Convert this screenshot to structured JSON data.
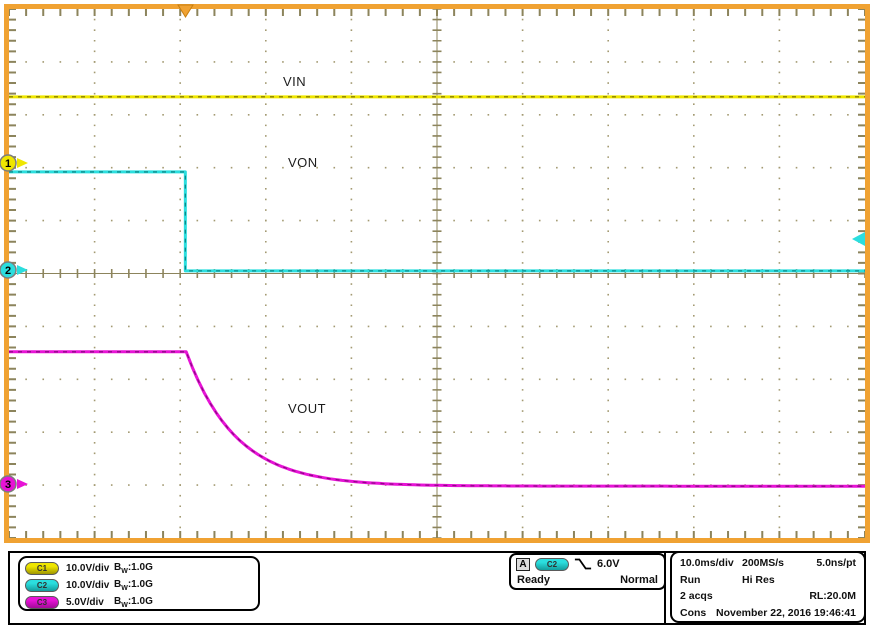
{
  "colors": {
    "frame": "#F0A232",
    "graticule": "#8C845C",
    "grid_dot": "#A39A72",
    "c1": {
      "main": "#EFE600",
      "dark": "#8A8000"
    },
    "c2": {
      "main": "#2BDEDE",
      "dark": "#0C8A8A"
    },
    "c3": {
      "main": "#E713D6",
      "dark": "#8F0886"
    }
  },
  "display": {
    "labels": {
      "vin": "VIN",
      "von": "VON",
      "vout": "VOUT"
    }
  },
  "markers": {
    "channel_refs": [
      {
        "label": "1",
        "channel": "C1",
        "y_div": 2.91
      },
      {
        "label": "2",
        "channel": "C2",
        "y_div": 4.93
      },
      {
        "label": "3",
        "channel": "C3",
        "y_div": 8.98
      }
    ],
    "trigger_position": {
      "x_div": 2.06
    },
    "trigger_level": {
      "y_div": 4.35,
      "channel": "C2"
    }
  },
  "channels": [
    {
      "id": "C1",
      "scale": "10.0V/div",
      "bw_b": "B",
      "bw_sub": "W",
      "bw_val": ":1.0G"
    },
    {
      "id": "C2",
      "scale": "10.0V/div",
      "bw_b": "B",
      "bw_sub": "W",
      "bw_val": ":1.0G"
    },
    {
      "id": "C3",
      "scale": "5.0V/div",
      "bw_b": "B",
      "bw_sub": "W",
      "bw_val": ":1.0G"
    }
  ],
  "trigger": {
    "source": "A",
    "channel": "C2",
    "slope_icon": "falling-edge",
    "level": "6.0V",
    "state": "Ready",
    "mode": "Normal"
  },
  "horizontal": {
    "scale": "10.0ms/div",
    "sample_rate": "200MS/s",
    "resolution": "5.0ns/pt",
    "acq_state": "Run",
    "acq_mode": "Hi Res",
    "acquisitions": "2 acqs",
    "record_length": "RL:20.0M",
    "label_cons": "Cons",
    "date": "November 22, 2016",
    "time": "19:46:41"
  },
  "chart_data": {
    "type": "line",
    "x_axis": {
      "scale_per_div": "10.0ms",
      "divisions": 10
    },
    "y_axis": {
      "divisions": 10
    },
    "trigger_x_div": 2.06,
    "series": [
      {
        "name": "VIN",
        "channel": "C1",
        "volts_per_div": 10.0,
        "color_key": "c1",
        "shape": "constant",
        "level_y_div": 1.66,
        "ref_y_div": 2.91,
        "approx_volts": 12.5
      },
      {
        "name": "VON",
        "channel": "C2",
        "volts_per_div": 10.0,
        "color_key": "c2",
        "shape": "step_down",
        "high_y_div": 3.08,
        "low_y_div": 4.95,
        "step_x_div": 2.06,
        "ref_y_div": 4.93,
        "approx_high_volts": 18.5,
        "approx_low_volts": 0
      },
      {
        "name": "VOUT",
        "channel": "C3",
        "volts_per_div": 5.0,
        "color_key": "c3",
        "shape": "exponential_decay",
        "high_y_div": 6.48,
        "asymptote_y_div": 9.02,
        "knee_x_div": 2.07,
        "tau_div": 0.58,
        "ref_y_div": 8.98,
        "approx_high_volts": 12.5,
        "approx_final_volts": 0
      }
    ]
  }
}
